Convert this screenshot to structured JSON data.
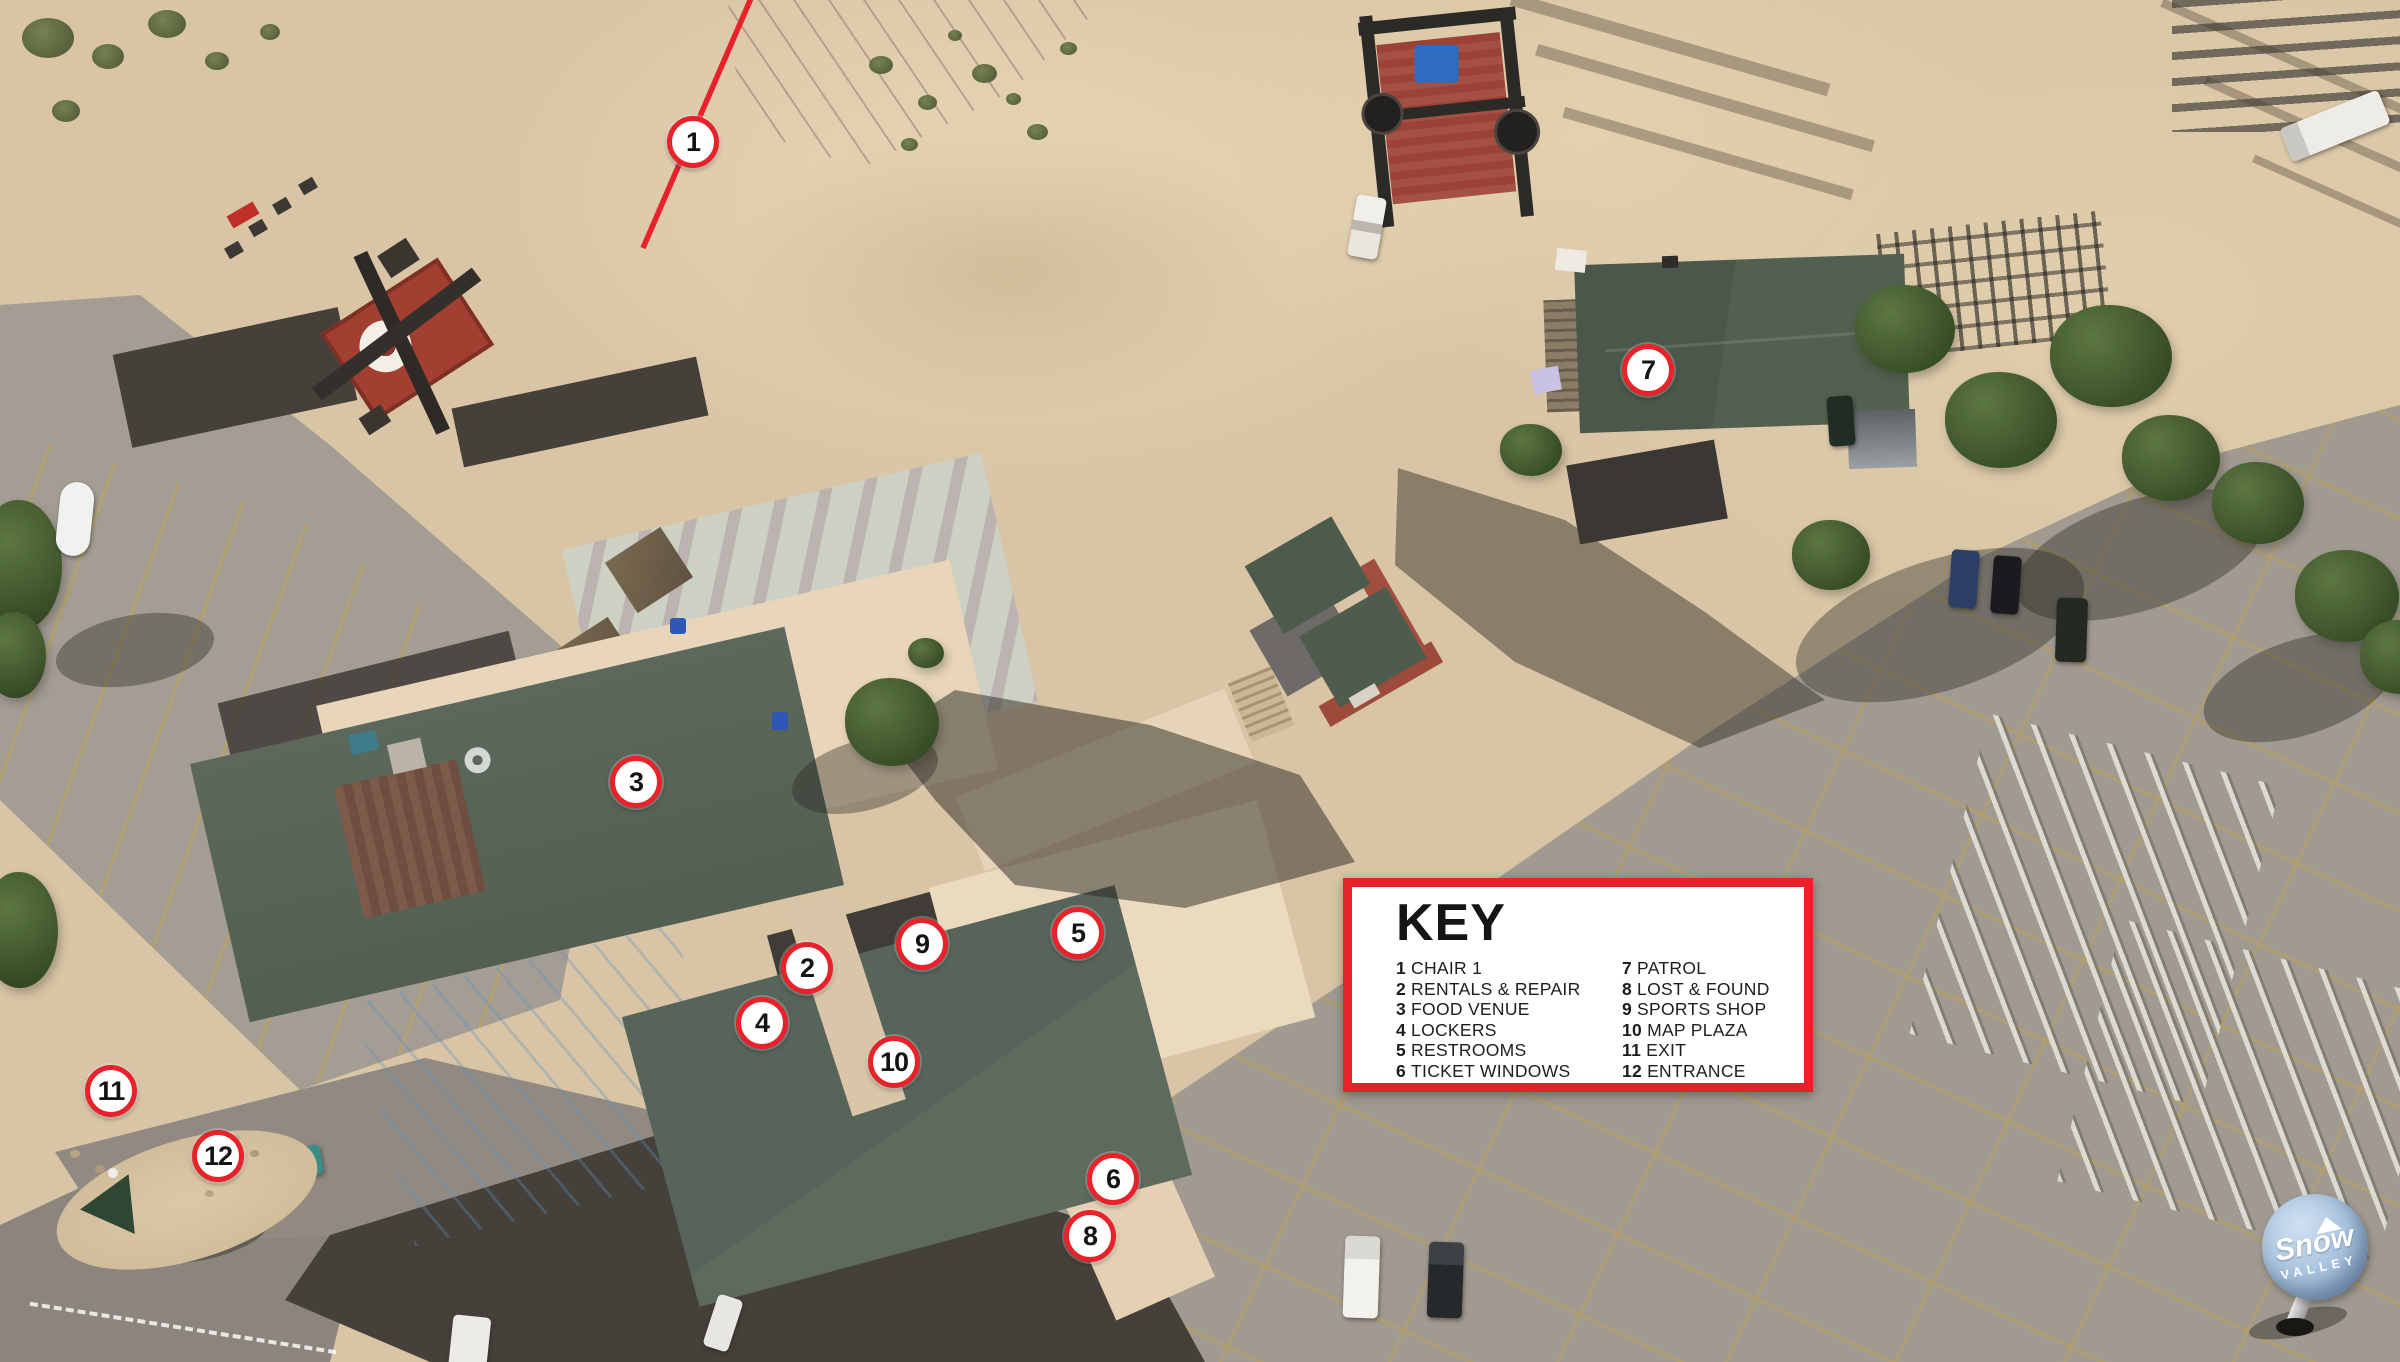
{
  "map": {
    "markers": [
      {
        "num": "1"
      },
      {
        "num": "2"
      },
      {
        "num": "3"
      },
      {
        "num": "4"
      },
      {
        "num": "5"
      },
      {
        "num": "6"
      },
      {
        "num": "7"
      },
      {
        "num": "8"
      },
      {
        "num": "9"
      },
      {
        "num": "10"
      },
      {
        "num": "11"
      },
      {
        "num": "12"
      }
    ]
  },
  "key": {
    "title": "KEY",
    "items": [
      {
        "num": "1",
        "label": "CHAIR 1"
      },
      {
        "num": "2",
        "label": "RENTALS & REPAIR"
      },
      {
        "num": "3",
        "label": "FOOD VENUE"
      },
      {
        "num": "4",
        "label": "LOCKERS"
      },
      {
        "num": "5",
        "label": "RESTROOMS"
      },
      {
        "num": "6",
        "label": "TICKET WINDOWS"
      },
      {
        "num": "7",
        "label": "PATROL"
      },
      {
        "num": "8",
        "label": "LOST & FOUND"
      },
      {
        "num": "9",
        "label": "SPORTS SHOP"
      },
      {
        "num": "10",
        "label": "MAP PLAZA"
      },
      {
        "num": "11",
        "label": "EXIT"
      },
      {
        "num": "12",
        "label": "ENTRANCE"
      }
    ]
  },
  "logo": {
    "line1": "Snow",
    "line2": "VALLEY"
  },
  "colors": {
    "accent_red": "#e8222b",
    "marker_fill": "#ffffff",
    "marker_text": "#141414",
    "key_background": "#ffffff",
    "logo_blue": "#a7c1dc",
    "roof_green": "#55625 5",
    "dirt_tan": "#d9c5a5",
    "asphalt_gray": "#a09a91"
  }
}
